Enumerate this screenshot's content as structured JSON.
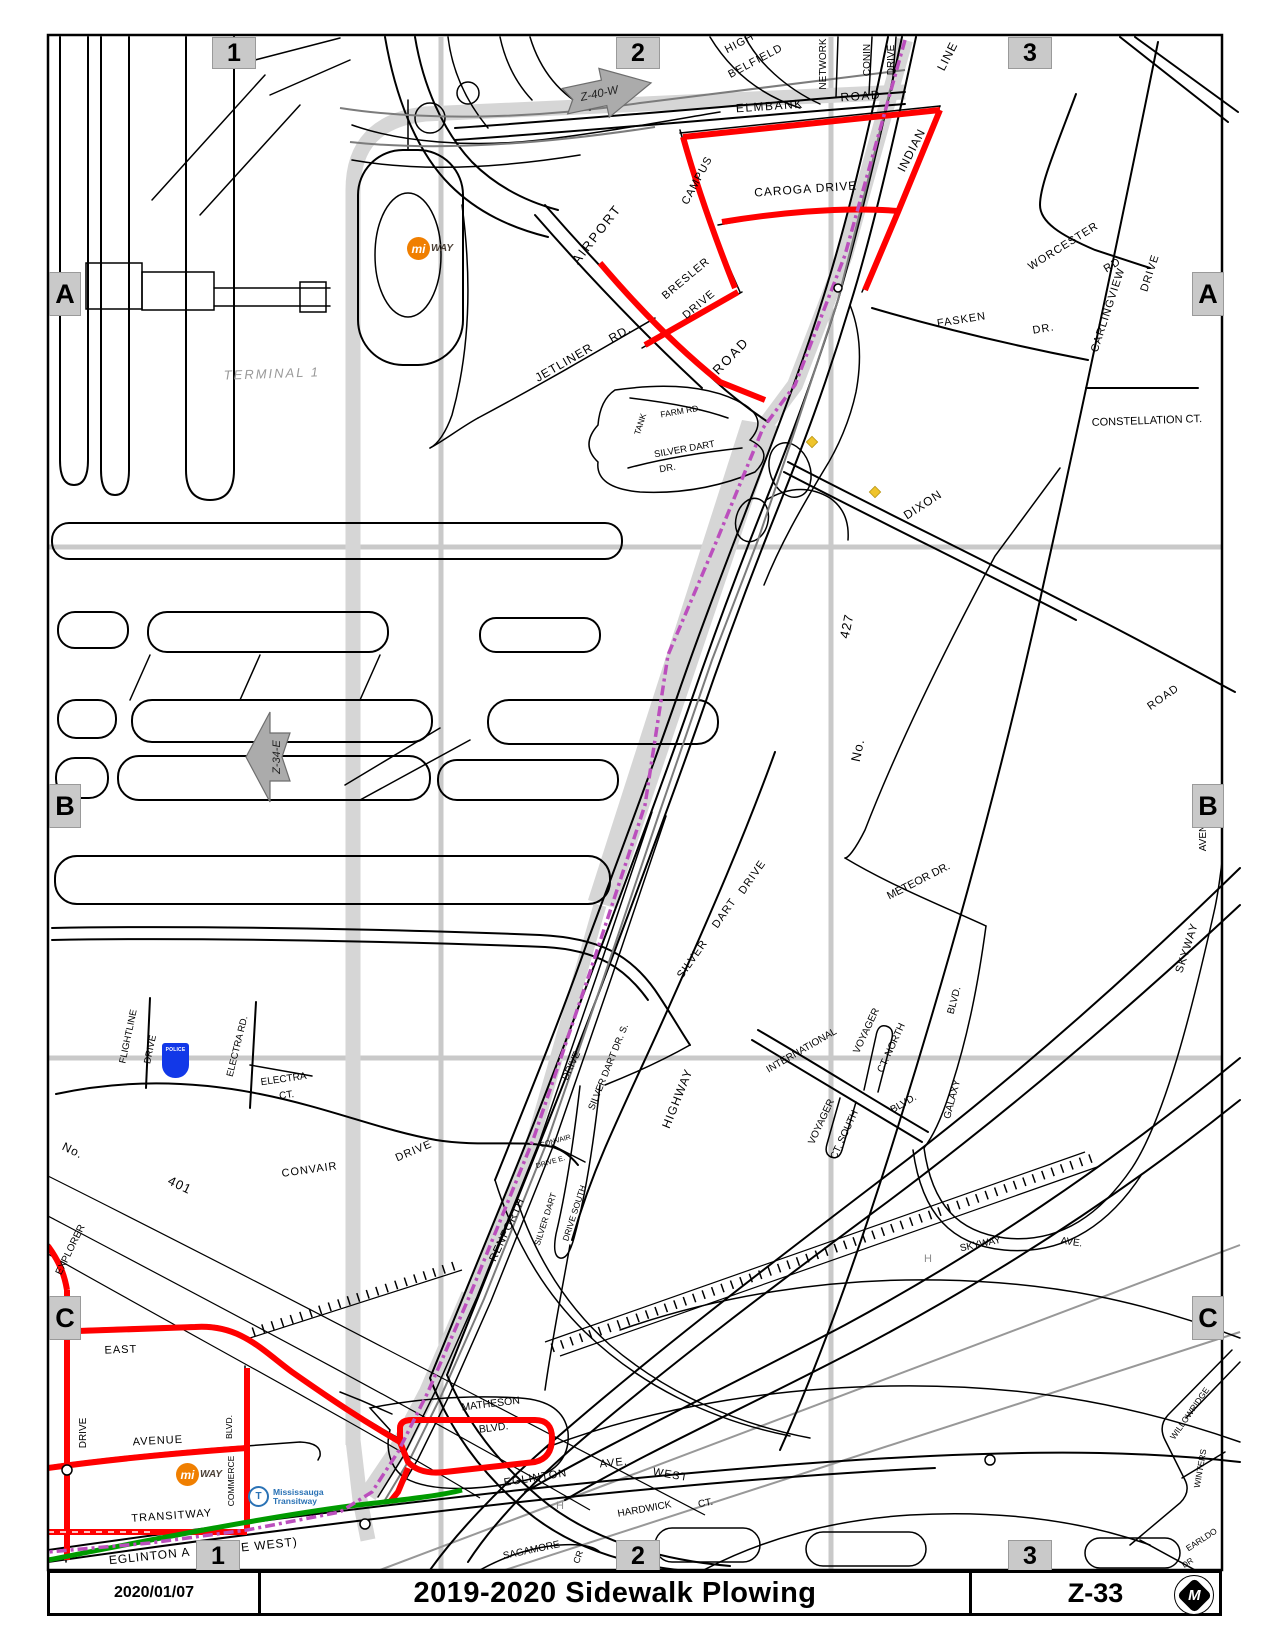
{
  "title_bar": {
    "date": "2020/01/07",
    "title": "2019-2020 Sidewalk Plowing",
    "sheet": "Z-33"
  },
  "grid": {
    "cols": [
      "1",
      "2",
      "3"
    ],
    "rows": [
      "A",
      "B",
      "C"
    ]
  },
  "arrows": {
    "z40": "Z-40-W",
    "z34": "Z-34-E"
  },
  "logos": {
    "miway_mi": "mi",
    "miway_way": "WAY",
    "transitway_icon": "T",
    "transitway_line1": "Mississauga",
    "transitway_line2": "Transitway",
    "police": "POLICE",
    "city_logo_letter": "M"
  },
  "colors": {
    "route_red": "#FF0000",
    "route_green": "#009B00",
    "boundary_purple": "#BB4FBD",
    "corridor_gray": "#D6D6D6",
    "grid_gray": "#C9C9C9",
    "marker_bg": "#C9C9C9",
    "arrow_gray": "#ABABAB",
    "rail_gray": "#7C7C7C",
    "hydro_gray": "#989898"
  },
  "map_labels": [
    {
      "t": "TERMINAL 1",
      "x": 272,
      "y": 378,
      "r": -2,
      "s": 13,
      "c": "#999999",
      "i": 1,
      "sp": 2
    },
    {
      "t": "HIGH",
      "x": 741,
      "y": 46,
      "r": -28,
      "s": 11,
      "sp": 1
    },
    {
      "t": "BELFIELD",
      "x": 757,
      "y": 64,
      "r": -28,
      "s": 11,
      "sp": 1
    },
    {
      "t": "NETWORK",
      "x": 826,
      "y": 64,
      "r": -90,
      "s": 10
    },
    {
      "t": "CONIN",
      "x": 870,
      "y": 60,
      "r": -90,
      "s": 10
    },
    {
      "t": "DRIVE",
      "x": 894,
      "y": 60,
      "r": -90,
      "s": 10
    },
    {
      "t": "ELMBANK",
      "x": 770,
      "y": 110,
      "r": -4,
      "s": 12,
      "sp": 1.5
    },
    {
      "t": "ROAD",
      "x": 861,
      "y": 100,
      "r": -4,
      "s": 12,
      "sp": 1.5
    },
    {
      "t": "CAMPUS",
      "x": 700,
      "y": 182,
      "r": -62,
      "s": 11,
      "sp": 1
    },
    {
      "t": "CAROGA DRIVE",
      "x": 806,
      "y": 193,
      "r": -4,
      "s": 12,
      "sp": 1
    },
    {
      "t": "INDIAN",
      "x": 915,
      "y": 152,
      "r": -63,
      "s": 12,
      "sp": 1
    },
    {
      "t": "LINE",
      "x": 951,
      "y": 58,
      "r": -63,
      "s": 12,
      "sp": 1
    },
    {
      "t": "AIRPORT",
      "x": 600,
      "y": 237,
      "r": -52,
      "s": 13,
      "sp": 2
    },
    {
      "t": "ROAD",
      "x": 734,
      "y": 359,
      "r": -46,
      "s": 13,
      "sp": 2
    },
    {
      "t": "BRESLER",
      "x": 688,
      "y": 281,
      "r": -40,
      "s": 11,
      "sp": 1
    },
    {
      "t": "DRIVE",
      "x": 701,
      "y": 307,
      "r": -40,
      "s": 11,
      "sp": 1
    },
    {
      "t": "JETLINER",
      "x": 566,
      "y": 366,
      "r": -30,
      "s": 12,
      "sp": 1
    },
    {
      "t": "RD.",
      "x": 622,
      "y": 337,
      "r": -30,
      "s": 12,
      "sp": 1
    },
    {
      "t": "TANK",
      "x": 643,
      "y": 425,
      "r": -72,
      "s": 8.5
    },
    {
      "t": "FARM RD.",
      "x": 681,
      "y": 414,
      "r": -10,
      "s": 8.5
    },
    {
      "t": "SILVER DART",
      "x": 685,
      "y": 452,
      "r": -10,
      "s": 9.5
    },
    {
      "t": "DR.",
      "x": 668,
      "y": 471,
      "r": -10,
      "s": 9.5
    },
    {
      "t": "WORCESTER",
      "x": 1065,
      "y": 249,
      "r": -32,
      "s": 11,
      "sp": 1
    },
    {
      "t": "RD",
      "x": 1114,
      "y": 268,
      "r": -32,
      "s": 11,
      "sp": 1
    },
    {
      "t": "CARLINGVIEW",
      "x": 1111,
      "y": 311,
      "r": -72,
      "s": 11,
      "sp": 1
    },
    {
      "t": "DRIVE",
      "x": 1153,
      "y": 274,
      "r": -72,
      "s": 11,
      "sp": 1
    },
    {
      "t": "CONSTELLATION CT.",
      "x": 1147,
      "y": 424,
      "r": -2,
      "s": 11
    },
    {
      "t": "FASKEN",
      "x": 962,
      "y": 323,
      "r": -9,
      "s": 11,
      "sp": 1
    },
    {
      "t": "DR.",
      "x": 1044,
      "y": 332,
      "r": -9,
      "s": 11,
      "sp": 1
    },
    {
      "t": "DIXON",
      "x": 925,
      "y": 508,
      "r": -33,
      "s": 12,
      "sp": 1
    },
    {
      "t": "427",
      "x": 851,
      "y": 627,
      "r": -78,
      "s": 13,
      "sp": 1
    },
    {
      "t": "No.",
      "x": 862,
      "y": 751,
      "r": -78,
      "s": 13,
      "sp": 1
    },
    {
      "t": "ROAD",
      "x": 1165,
      "y": 700,
      "r": -35,
      "s": 11,
      "sp": 1
    },
    {
      "t": "METEOR DR.",
      "x": 920,
      "y": 884,
      "r": -27,
      "s": 11
    },
    {
      "t": "SKYWAY",
      "x": 1190,
      "y": 949,
      "r": -72,
      "s": 11,
      "sp": 1
    },
    {
      "t": "AVEN",
      "x": 1206,
      "y": 838,
      "r": -90,
      "s": 10
    },
    {
      "t": "SILVER",
      "x": 695,
      "y": 961,
      "r": -55,
      "s": 11,
      "sp": 1
    },
    {
      "t": "DART",
      "x": 727,
      "y": 915,
      "r": -55,
      "s": 11,
      "sp": 1
    },
    {
      "t": "DRIVE",
      "x": 755,
      "y": 879,
      "r": -55,
      "s": 11,
      "sp": 1
    },
    {
      "t": "HIGHWAY",
      "x": 681,
      "y": 1100,
      "r": -68,
      "s": 12,
      "sp": 1
    },
    {
      "t": "INTERNATIONAL",
      "x": 803,
      "y": 1053,
      "r": -30,
      "s": 10
    },
    {
      "t": "BLVD.",
      "x": 905,
      "y": 1106,
      "r": -30,
      "s": 10
    },
    {
      "t": "VOYAGER",
      "x": 869,
      "y": 1032,
      "r": -65,
      "s": 10
    },
    {
      "t": "CT. NORTH",
      "x": 894,
      "y": 1049,
      "r": -65,
      "s": 10
    },
    {
      "t": "VOYAGER",
      "x": 824,
      "y": 1123,
      "r": -65,
      "s": 10
    },
    {
      "t": "CT. SOUTH",
      "x": 847,
      "y": 1136,
      "r": -65,
      "s": 10
    },
    {
      "t": "GALAXY",
      "x": 955,
      "y": 1100,
      "r": -75,
      "s": 10
    },
    {
      "t": "BLVD.",
      "x": 957,
      "y": 1001,
      "r": -75,
      "s": 10
    },
    {
      "t": "SKYWAY",
      "x": 981,
      "y": 1247,
      "r": -12,
      "s": 10
    },
    {
      "t": "AVE.",
      "x": 1071,
      "y": 1245,
      "r": 8,
      "s": 10
    },
    {
      "t": "SILVER DART DR. S.",
      "x": 611,
      "y": 1068,
      "r": -68,
      "s": 9.5
    },
    {
      "t": "DRIVE",
      "x": 574,
      "y": 1067,
      "r": -65,
      "s": 10
    },
    {
      "t": "RENFORTH",
      "x": 510,
      "y": 1231,
      "r": -65,
      "s": 11,
      "sp": 1
    },
    {
      "t": "CONVAIR",
      "x": 310,
      "y": 1173,
      "r": -8,
      "s": 11,
      "sp": 1
    },
    {
      "t": "DRIVE",
      "x": 415,
      "y": 1154,
      "r": -23,
      "s": 11,
      "sp": 1
    },
    {
      "t": "CONVAIR",
      "x": 556,
      "y": 1143,
      "r": -16,
      "s": 7
    },
    {
      "t": "DRIVE E.",
      "x": 551,
      "y": 1164,
      "r": -16,
      "s": 7
    },
    {
      "t": "SILVER DART",
      "x": 548,
      "y": 1220,
      "r": -72,
      "s": 8.5
    },
    {
      "t": "DRIVE SOUTH",
      "x": 577,
      "y": 1214,
      "r": -72,
      "s": 8.5
    },
    {
      "t": "No.",
      "x": 71,
      "y": 1154,
      "r": 26,
      "s": 12,
      "sp": 1
    },
    {
      "t": "401",
      "x": 178,
      "y": 1189,
      "r": 26,
      "s": 13,
      "sp": 1
    },
    {
      "t": "FLIGHTLINE",
      "x": 131,
      "y": 1037,
      "r": -78,
      "s": 9.5
    },
    {
      "t": "DRIVE",
      "x": 153,
      "y": 1050,
      "r": -78,
      "s": 9.5
    },
    {
      "t": "ELECTRA RD.",
      "x": 240,
      "y": 1047,
      "r": -76,
      "s": 9.5
    },
    {
      "t": "ELECTRA",
      "x": 284,
      "y": 1082,
      "r": -8,
      "s": 10
    },
    {
      "t": "CT.",
      "x": 287,
      "y": 1098,
      "r": -8,
      "s": 10
    },
    {
      "t": "EXPLORER",
      "x": 73,
      "y": 1251,
      "r": -64,
      "s": 10
    },
    {
      "t": "DRIVE",
      "x": 86,
      "y": 1433,
      "r": -90,
      "s": 10
    },
    {
      "t": "EAST",
      "x": 121,
      "y": 1353,
      "r": -2,
      "s": 11,
      "sp": 1
    },
    {
      "t": "AVENUE",
      "x": 158,
      "y": 1444,
      "r": -3,
      "s": 11,
      "sp": 1
    },
    {
      "t": "TRANSITWAY",
      "x": 172,
      "y": 1519,
      "r": -4,
      "s": 11,
      "sp": 1
    },
    {
      "t": "COMMERCE",
      "x": 234,
      "y": 1481,
      "r": -90,
      "s": 8.5
    },
    {
      "t": "BLVD.",
      "x": 232,
      "y": 1427,
      "r": -90,
      "s": 8.5
    },
    {
      "t": "MATHESON",
      "x": 491,
      "y": 1407,
      "r": -7,
      "s": 10.5
    },
    {
      "t": "BLVD.",
      "x": 494,
      "y": 1431,
      "r": -7,
      "s": 10.5
    },
    {
      "t": "EGLINTON",
      "x": 536,
      "y": 1481,
      "r": -9,
      "s": 11,
      "sp": 1
    },
    {
      "t": "AVE.",
      "x": 614,
      "y": 1466,
      "r": -6,
      "s": 11,
      "sp": 1
    },
    {
      "t": "WEST",
      "x": 670,
      "y": 1478,
      "r": 10,
      "s": 11,
      "sp": 1
    },
    {
      "t": "HARDWICK",
      "x": 645,
      "y": 1512,
      "r": -10,
      "s": 10
    },
    {
      "t": "CT.",
      "x": 706,
      "y": 1506,
      "r": -10,
      "s": 10
    },
    {
      "t": "SAGAMORE",
      "x": 532,
      "y": 1553,
      "r": -12,
      "s": 10
    },
    {
      "t": "CR",
      "x": 581,
      "y": 1558,
      "r": -70,
      "s": 9
    },
    {
      "t": "EGLINTON A",
      "x": 150,
      "y": 1560,
      "r": -6,
      "s": 12,
      "sp": 1
    },
    {
      "t": "UE WEST)",
      "x": 265,
      "y": 1549,
      "r": -6,
      "s": 12,
      "sp": 1
    },
    {
      "t": "H",
      "x": 560,
      "y": 1509,
      "r": 0,
      "s": 11,
      "c": "#8C8C8C"
    },
    {
      "t": "H",
      "x": 928,
      "y": 1262,
      "r": 0,
      "s": 11,
      "c": "#8C8C8C"
    },
    {
      "t": "WILLOWRIDGE",
      "x": 1192,
      "y": 1415,
      "r": -55,
      "s": 8.5
    },
    {
      "t": "WINTERS",
      "x": 1203,
      "y": 1469,
      "r": -80,
      "s": 8.5
    },
    {
      "t": "EARLDO",
      "x": 1203,
      "y": 1542,
      "r": -33,
      "s": 8.5
    },
    {
      "t": "DR",
      "x": 1189,
      "y": 1565,
      "r": -33,
      "s": 8
    }
  ]
}
